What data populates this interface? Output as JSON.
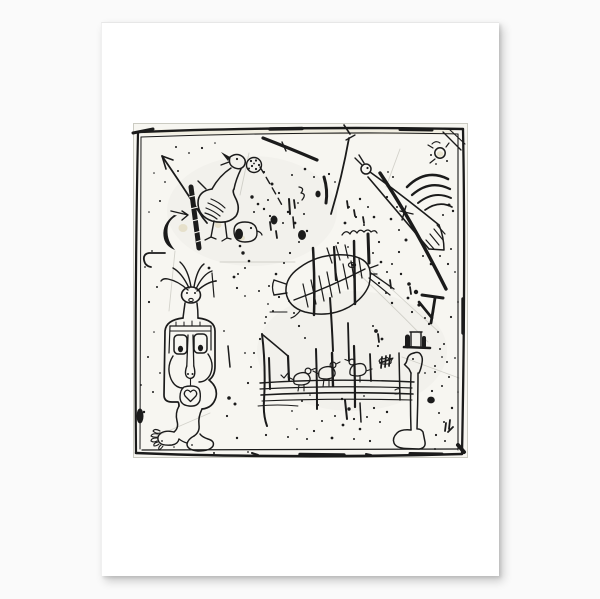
{
  "scene": {
    "background_color": "#fafafa",
    "paper_color": "#ffffff",
    "plate_color": "#f7f6f1",
    "ink_color": "#1b1b1b",
    "tint_color": "#c9b97f",
    "scratch_color": "#99998f",
    "plate_edge_color": "#cbcbc2"
  },
  "artwork": {
    "kind": "black-and-white abstract line etching printed on white paper",
    "figures": [
      {
        "name": "frame-border",
        "desc": "hand-drawn irregular double square border"
      },
      {
        "name": "arrow-figure",
        "desc": "long arrow pointing to upper left"
      },
      {
        "name": "goose-figure",
        "desc": "goose with open beak and spotted egg, small creature at its feet"
      },
      {
        "name": "sickle-figure",
        "desc": "crescent hook with dark hatched band and small arrow"
      },
      {
        "name": "cone-bird-figure",
        "desc": "bird with round head, long cone body, hatched tail and plume arcs"
      },
      {
        "name": "corner-sun",
        "desc": "small sun circle with rays in top-right corner"
      },
      {
        "name": "fish-skeleton-figure",
        "desc": "fish with eye, open mouth and exposed rib skeleton"
      },
      {
        "name": "totem-figure",
        "desc": "standing figure with antennae hair, boxed eyes, long nose, heart mouth and bare feet"
      },
      {
        "name": "fence-with-birds",
        "desc": "four wavy rails with small perched birds and posts"
      },
      {
        "name": "bone-figure",
        "desc": "upright bone with profile head, top hat and shoe-like foot"
      },
      {
        "name": "ink-splatter",
        "desc": "scattered etching ink spots, dashes and scratches"
      }
    ]
  }
}
